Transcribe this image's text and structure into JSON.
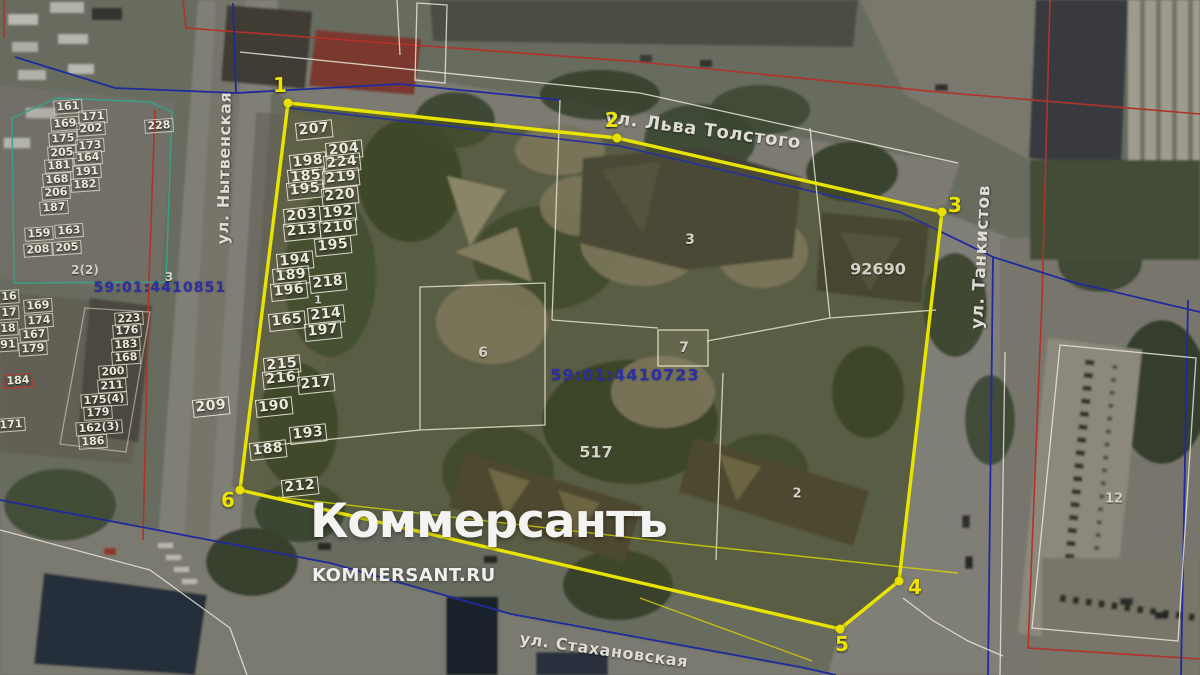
{
  "watermark": {
    "title": "Коммерсантъ",
    "subtitle": "KOMMERSANT.RU"
  },
  "map": {
    "street_labels": [
      {
        "name": "ул. Льва Толстого",
        "x": 703,
        "y": 130,
        "rotate": 7.5,
        "size": 18
      },
      {
        "name": "ул. Танкистов",
        "x": 981,
        "y": 257,
        "rotate": -87,
        "size": 17
      },
      {
        "name": "ул. Нытвенская",
        "x": 224,
        "y": 168,
        "rotate": -89,
        "size": 16
      },
      {
        "name": "ул. Стахановская",
        "x": 604,
        "y": 650,
        "rotate": 8,
        "size": 16
      }
    ],
    "cadastral_numbers": [
      {
        "number": "59:01:4410851",
        "x": 160,
        "y": 288,
        "size": 14
      },
      {
        "number": "59:01:4410723",
        "x": 625,
        "y": 375,
        "size": 16
      }
    ],
    "building_labels": [
      {
        "label": "3",
        "x": 690,
        "y": 240,
        "size": 14
      },
      {
        "label": "6",
        "x": 483,
        "y": 353,
        "size": 14
      },
      {
        "label": "7",
        "x": 684,
        "y": 348,
        "size": 14
      },
      {
        "label": "517",
        "x": 596,
        "y": 452,
        "size": 16
      },
      {
        "label": "2",
        "x": 797,
        "y": 494,
        "size": 13
      },
      {
        "label": "92690",
        "x": 878,
        "y": 269,
        "size": 16
      },
      {
        "label": "12",
        "x": 1114,
        "y": 499,
        "size": 13
      },
      {
        "label": "1",
        "x": 318,
        "y": 300,
        "size": 11
      },
      {
        "label": "3",
        "x": 169,
        "y": 277,
        "size": 12
      },
      {
        "label": "2(2)",
        "x": 85,
        "y": 270,
        "size": 12
      }
    ],
    "boundary_vertices": [
      {
        "n": "1",
        "x": 288,
        "y": 103,
        "lx": 280,
        "ly": 85
      },
      {
        "n": "2",
        "x": 617,
        "y": 138,
        "lx": 612,
        "ly": 120
      },
      {
        "n": "3",
        "x": 942,
        "y": 212,
        "lx": 955,
        "ly": 205
      },
      {
        "n": "4",
        "x": 899,
        "y": 581,
        "lx": 915,
        "ly": 587
      },
      {
        "n": "5",
        "x": 840,
        "y": 629,
        "lx": 842,
        "ly": 644
      },
      {
        "n": "6",
        "x": 240,
        "y": 490,
        "lx": 228,
        "ly": 500
      }
    ],
    "parcel_groups": [
      {
        "css": "pg-inner",
        "rotate": -6,
        "items": [
          {
            "label": "207",
            "x": 314,
            "y": 130
          },
          {
            "label": "204",
            "x": 344,
            "y": 150
          },
          {
            "label": "198",
            "x": 308,
            "y": 162
          },
          {
            "label": "224",
            "x": 342,
            "y": 163
          },
          {
            "label": "185",
            "x": 306,
            "y": 177
          },
          {
            "label": "219",
            "x": 341,
            "y": 178
          },
          {
            "label": "195",
            "x": 305,
            "y": 190
          },
          {
            "label": "220",
            "x": 340,
            "y": 196
          },
          {
            "label": "203",
            "x": 302,
            "y": 216
          },
          {
            "label": "192",
            "x": 338,
            "y": 213
          },
          {
            "label": "213",
            "x": 302,
            "y": 231
          },
          {
            "label": "210",
            "x": 338,
            "y": 228
          },
          {
            "label": "195",
            "x": 333,
            "y": 246
          },
          {
            "label": "194",
            "x": 295,
            "y": 261
          },
          {
            "label": "189",
            "x": 291,
            "y": 276
          },
          {
            "label": "218",
            "x": 328,
            "y": 283
          },
          {
            "label": "196",
            "x": 289,
            "y": 291
          },
          {
            "label": "214",
            "x": 326,
            "y": 315
          },
          {
            "label": "165",
            "x": 287,
            "y": 321
          },
          {
            "label": "197",
            "x": 323,
            "y": 331
          },
          {
            "label": "215",
            "x": 282,
            "y": 365
          },
          {
            "label": "216",
            "x": 281,
            "y": 379
          },
          {
            "label": "217",
            "x": 316,
            "y": 384
          },
          {
            "label": "190",
            "x": 274,
            "y": 407
          },
          {
            "label": "193",
            "x": 308,
            "y": 434
          },
          {
            "label": "188",
            "x": 268,
            "y": 450
          },
          {
            "label": "212",
            "x": 300,
            "y": 487
          },
          {
            "label": "209",
            "x": 211,
            "y": 407
          }
        ]
      },
      {
        "css": "pg-small",
        "rotate": -4,
        "items": [
          {
            "label": "161",
            "x": 68,
            "y": 107
          },
          {
            "label": "171",
            "x": 93,
            "y": 117
          },
          {
            "label": "169",
            "x": 65,
            "y": 124
          },
          {
            "label": "202",
            "x": 91,
            "y": 129
          },
          {
            "label": "175",
            "x": 63,
            "y": 139
          },
          {
            "label": "173",
            "x": 90,
            "y": 146
          },
          {
            "label": "205",
            "x": 62,
            "y": 153
          },
          {
            "label": "164",
            "x": 88,
            "y": 158
          },
          {
            "label": "181",
            "x": 59,
            "y": 166
          },
          {
            "label": "191",
            "x": 87,
            "y": 172
          },
          {
            "label": "168",
            "x": 57,
            "y": 180
          },
          {
            "label": "182",
            "x": 85,
            "y": 185
          },
          {
            "label": "206",
            "x": 56,
            "y": 193
          },
          {
            "label": "187",
            "x": 54,
            "y": 208
          },
          {
            "label": "228",
            "x": 159,
            "y": 126
          }
        ]
      },
      {
        "css": "pg-small",
        "rotate": -4,
        "items": [
          {
            "label": "159",
            "x": 39,
            "y": 234
          },
          {
            "label": "163",
            "x": 69,
            "y": 231
          },
          {
            "label": "208",
            "x": 38,
            "y": 250
          },
          {
            "label": "205",
            "x": 67,
            "y": 248
          },
          {
            "label": "16",
            "x": 9,
            "y": 297
          },
          {
            "label": "169",
            "x": 38,
            "y": 306
          },
          {
            "label": "17",
            "x": 9,
            "y": 313
          },
          {
            "label": "174",
            "x": 39,
            "y": 321
          },
          {
            "label": "18",
            "x": 8,
            "y": 329
          },
          {
            "label": "167",
            "x": 34,
            "y": 335
          },
          {
            "label": "91",
            "x": 8,
            "y": 345
          },
          {
            "label": "179",
            "x": 33,
            "y": 349
          },
          {
            "label": "171",
            "x": 11,
            "y": 425
          }
        ]
      },
      {
        "css": "pg-small",
        "rotate": -4,
        "items": [
          {
            "label": "223",
            "x": 129,
            "y": 319
          },
          {
            "label": "176",
            "x": 127,
            "y": 331
          },
          {
            "label": "183",
            "x": 126,
            "y": 345
          },
          {
            "label": "168",
            "x": 126,
            "y": 358
          },
          {
            "label": "200",
            "x": 113,
            "y": 372
          },
          {
            "label": "211",
            "x": 112,
            "y": 386
          },
          {
            "label": "175(4)",
            "x": 104,
            "y": 400
          },
          {
            "label": "179",
            "x": 98,
            "y": 413
          },
          {
            "label": "162(3)",
            "x": 99,
            "y": 428
          },
          {
            "label": "186",
            "x": 93,
            "y": 442
          }
        ]
      },
      {
        "css": "pg-small pg-red",
        "rotate": -4,
        "items": [
          {
            "label": "184",
            "x": 18,
            "y": 381
          }
        ]
      }
    ]
  }
}
